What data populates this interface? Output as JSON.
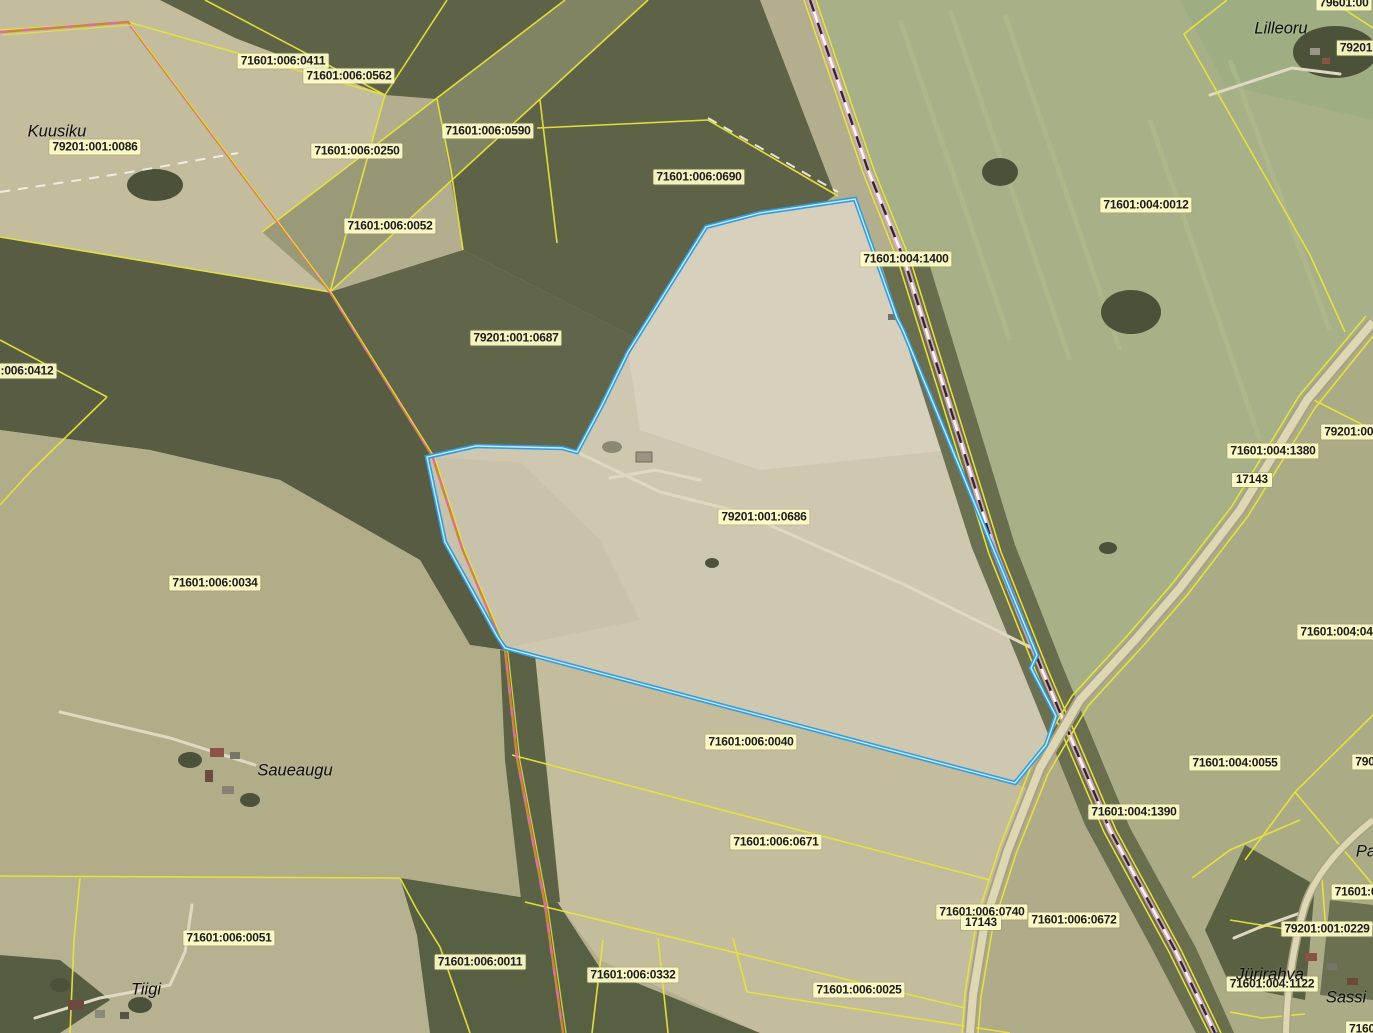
{
  "map": {
    "colors": {
      "boundary_yellow": "#e8e33c",
      "selected_parcel_blue": "#2f9ddf",
      "label_background": "#fffdc8",
      "label_text": "#1c1c1c",
      "railway_pink": "#e9b0c0",
      "road_fill": "#ded7b4",
      "place_text": "#0d0d0d"
    },
    "cadastral_labels": [
      {
        "text": "71601:006:0411",
        "x": 283,
        "y": 61
      },
      {
        "text": "71601:006:0562",
        "x": 349,
        "y": 76
      },
      {
        "text": "79201:001:0086",
        "x": 95,
        "y": 147
      },
      {
        "text": "71601:006:0250",
        "x": 357,
        "y": 151
      },
      {
        "text": "71601:006:0590",
        "x": 488,
        "y": 131
      },
      {
        "text": "71601:006:0690",
        "x": 699,
        "y": 177
      },
      {
        "text": "71601:006:0052",
        "x": 390,
        "y": 226
      },
      {
        "text": "71601:004:0012",
        "x": 1146,
        "y": 205
      },
      {
        "text": "71601:004:1400",
        "x": 906,
        "y": 259
      },
      {
        "text": ":006:0412",
        "x": 27,
        "y": 371
      },
      {
        "text": "79201:001:0687",
        "x": 516,
        "y": 338
      },
      {
        "text": "79201:001",
        "x": 1352,
        "y": 432
      },
      {
        "text": "71601:004:1380",
        "x": 1273,
        "y": 451
      },
      {
        "text": "79201:001:0686",
        "x": 764,
        "y": 517
      },
      {
        "text": "71601:006:0034",
        "x": 215,
        "y": 583
      },
      {
        "text": "71601:004:0421",
        "x": 1343,
        "y": 632
      },
      {
        "text": "71601:004:0055",
        "x": 1235,
        "y": 763
      },
      {
        "text": "790",
        "x": 1365,
        "y": 762
      },
      {
        "text": "71601:004:1390",
        "x": 1134,
        "y": 812
      },
      {
        "text": "71601:006:0040",
        "x": 751,
        "y": 742
      },
      {
        "text": "71601:006:0671",
        "x": 776,
        "y": 842
      },
      {
        "text": "71601:006:0740",
        "x": 982,
        "y": 912
      },
      {
        "text": "71601:006:0672",
        "x": 1074,
        "y": 920
      },
      {
        "text": "71601:006:0051",
        "x": 229,
        "y": 938
      },
      {
        "text": "71601:006:0011",
        "x": 480,
        "y": 962
      },
      {
        "text": "71601:006:0332",
        "x": 633,
        "y": 975
      },
      {
        "text": "71601:006:0025",
        "x": 859,
        "y": 990
      },
      {
        "text": "71601:0",
        "x": 1356,
        "y": 892
      },
      {
        "text": "79201:001:0229",
        "x": 1327,
        "y": 929
      },
      {
        "text": "71601:004:1122",
        "x": 1272,
        "y": 984
      },
      {
        "text": "7160",
        "x": 1362,
        "y": 1029
      },
      {
        "text": "79601:00",
        "x": 1344,
        "y": 3
      },
      {
        "text": "79201",
        "x": 1356,
        "y": 48
      }
    ],
    "road_number_labels": [
      {
        "text": "17143",
        "x": 1252,
        "y": 480
      },
      {
        "text": "17143",
        "x": 981,
        "y": 923
      }
    ],
    "place_labels": [
      {
        "text": "Kuusiku",
        "x": 57,
        "y": 132
      },
      {
        "text": "Lilleoru",
        "x": 1281,
        "y": 29
      },
      {
        "text": "Saueaugu",
        "x": 295,
        "y": 771
      },
      {
        "text": "Tiigi",
        "x": 146,
        "y": 990
      },
      {
        "text": "Jürirahva",
        "x": 1270,
        "y": 975
      },
      {
        "text": "Sassi",
        "x": 1346,
        "y": 998
      },
      {
        "text": "Pa",
        "x": 1366,
        "y": 852
      }
    ]
  }
}
